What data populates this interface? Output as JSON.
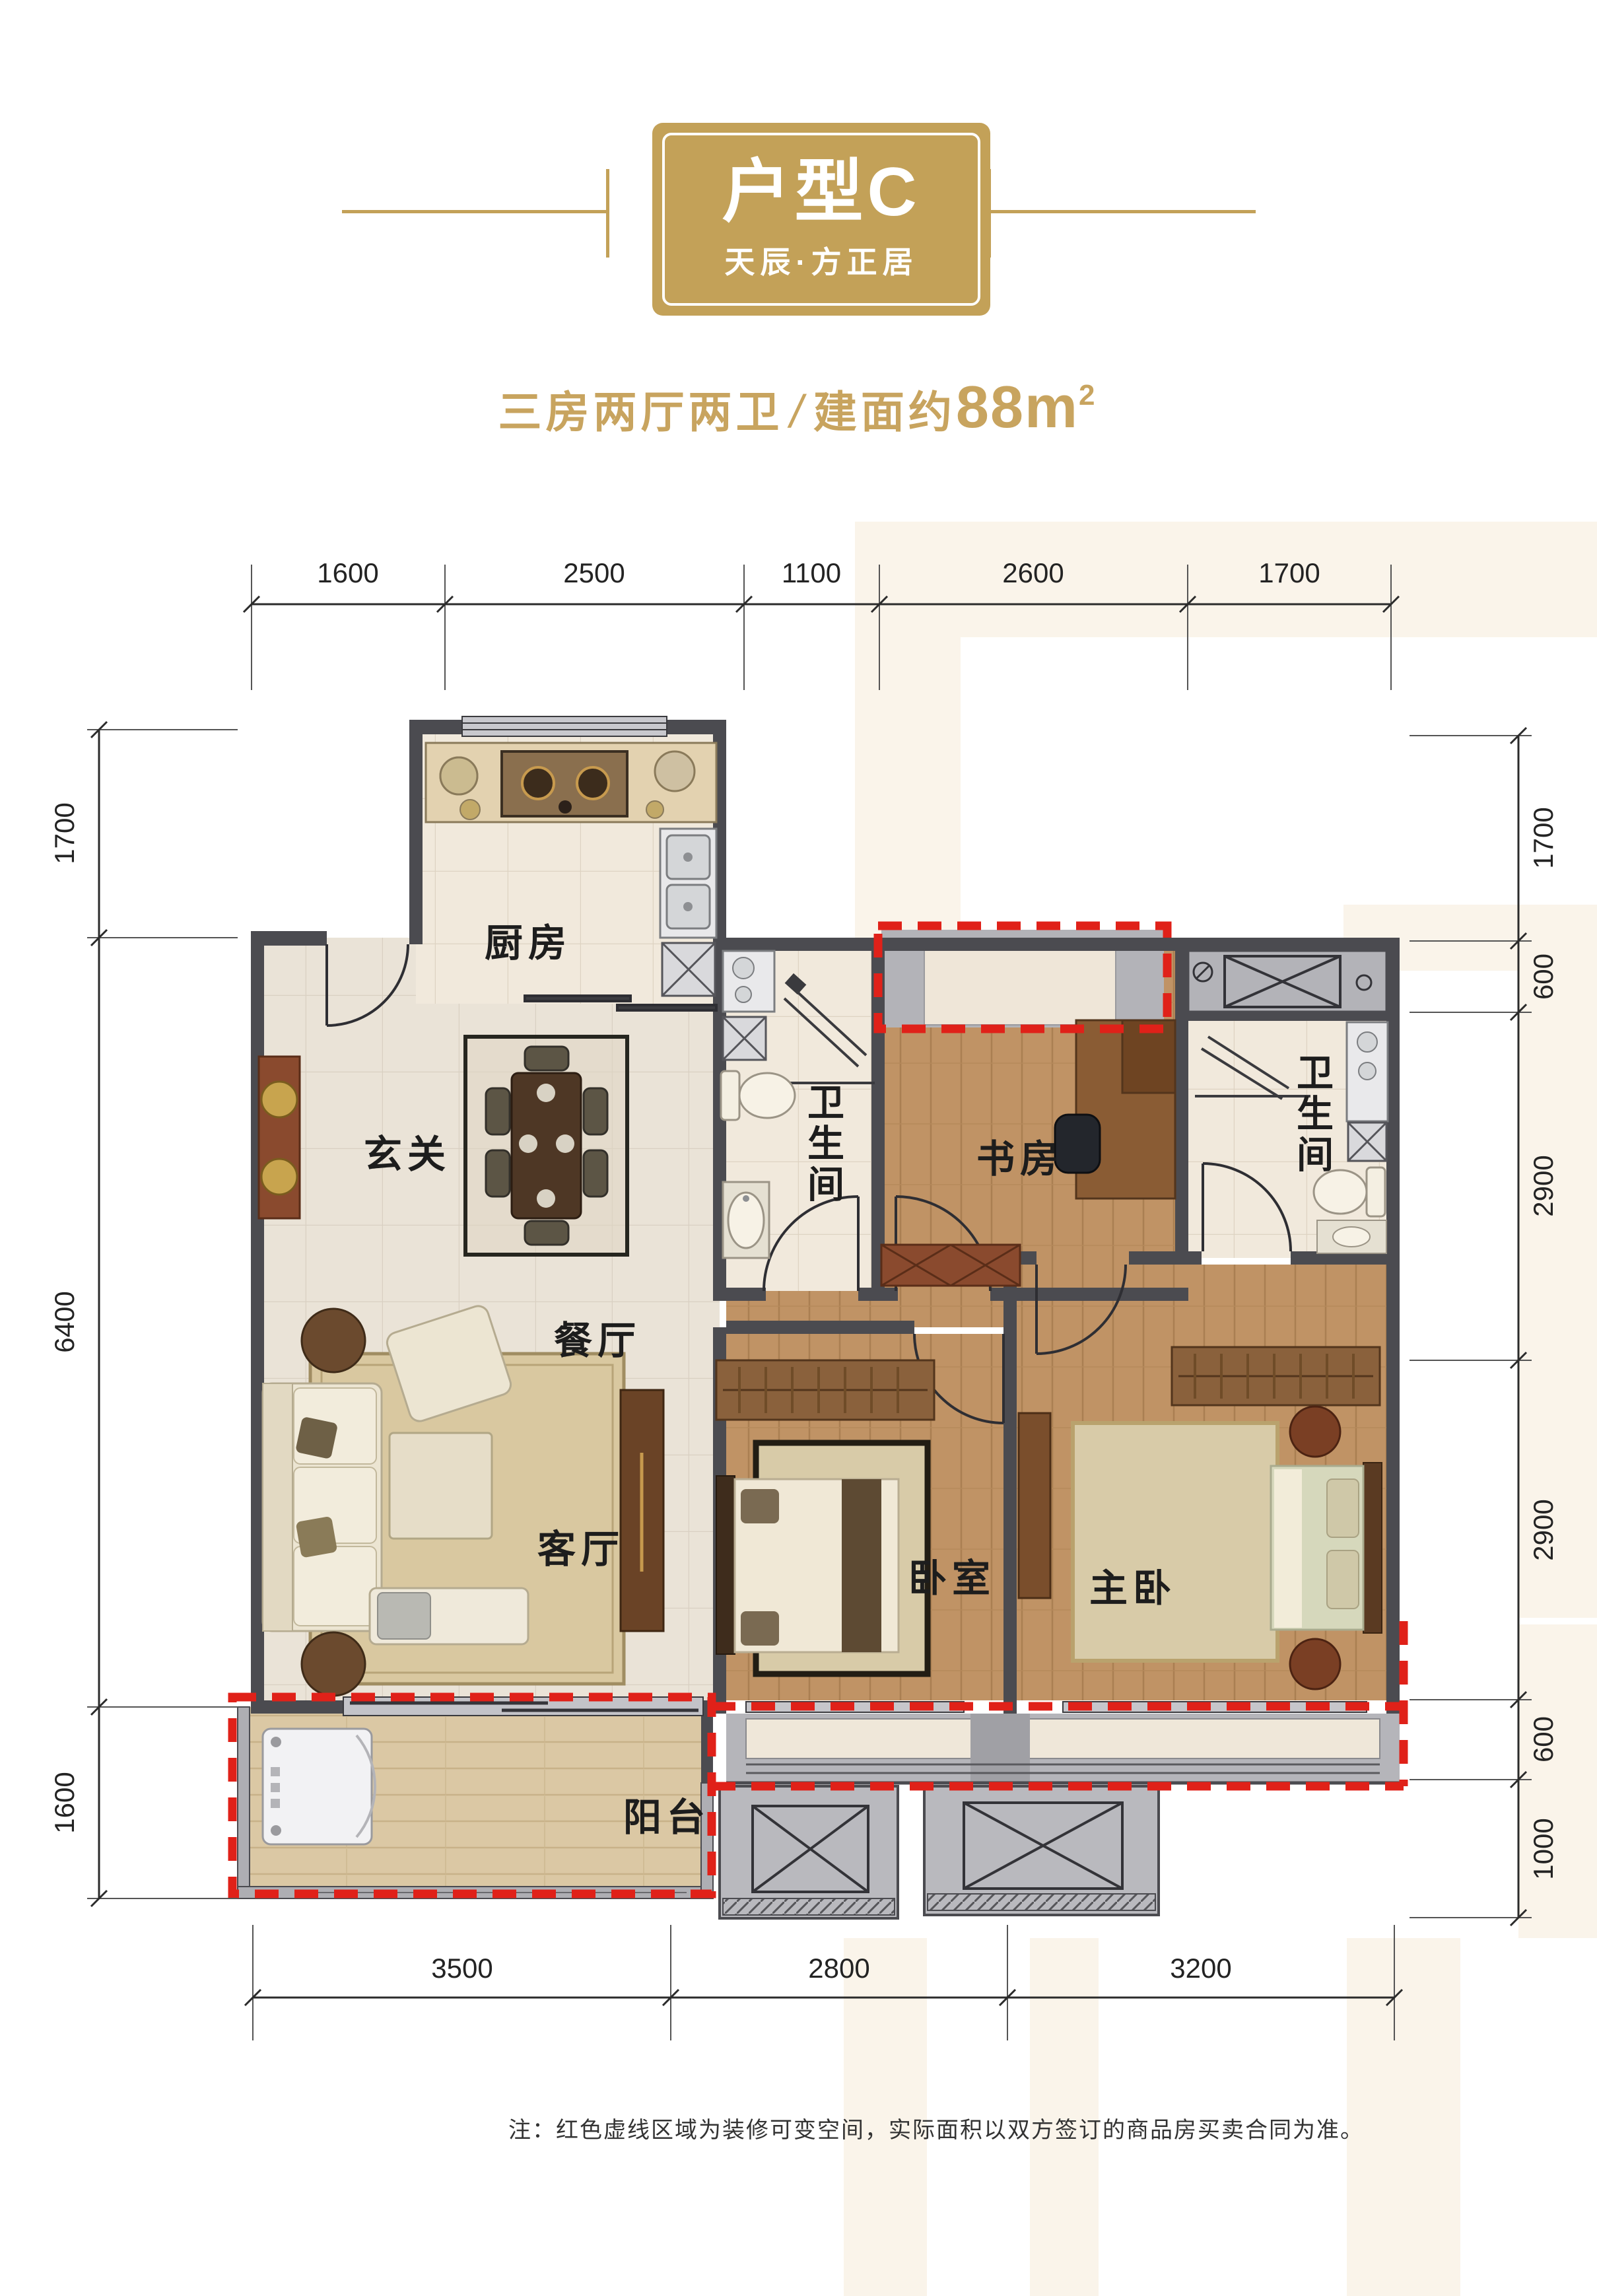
{
  "header": {
    "badge_title": "户型C",
    "badge_subtitle": "天辰·方正居",
    "tagline_left": "三房两厅两卫",
    "tagline_slash": "/",
    "tagline_right": "建面约",
    "tagline_area": "88m",
    "tagline_area_sup": "2"
  },
  "rooms": {
    "kitchen": "厨房",
    "entry": "玄关",
    "dining": "餐厅",
    "living": "客厅",
    "bath1": "卫生间",
    "study": "书房",
    "bath2": "卫生间",
    "bedroom": "卧室",
    "master": "主卧",
    "balcony": "阳台"
  },
  "dimensions": {
    "top": [
      "1600",
      "2500",
      "1100",
      "2600",
      "1700"
    ],
    "bottom": [
      "3500",
      "2800",
      "3200"
    ],
    "left": [
      "1700",
      "6400",
      "1600"
    ],
    "right": [
      "1700",
      "600",
      "2900",
      "2900",
      "600",
      "1000"
    ]
  },
  "note": "注：红色虚线区域为装修可变空间，实际面积以双方签订的商品房买卖合同为准。",
  "colors": {
    "gold": "#c3a158",
    "red_dashed": "#e02119",
    "wall_dark": "#4b4b50",
    "wall_gray": "#b2b2b7"
  }
}
